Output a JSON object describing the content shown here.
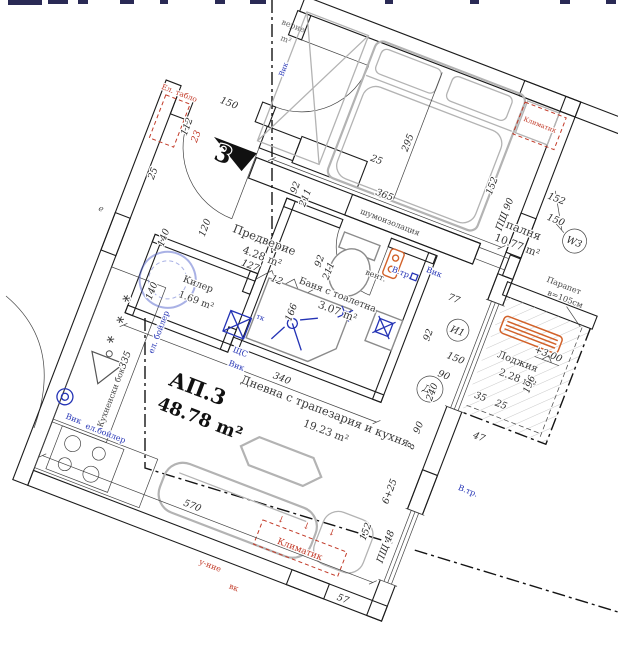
{
  "apartment": {
    "code": "АП.3",
    "area": "48.78 m²"
  },
  "rooms": {
    "bedroom": {
      "name": "Спалня",
      "area": "10.77 m²"
    },
    "hall": {
      "name": "Предверие",
      "area": "4.28 m²"
    },
    "storage": {
      "name": "Килер",
      "area": "1.69 m²"
    },
    "bathroom": {
      "name": "Баня с тоалетна",
      "area": "3.07 m²"
    },
    "living": {
      "name": "Дневна с трапезария и кухня",
      "area": "19.23 m²"
    },
    "loggia": {
      "name": "Лоджия",
      "area": "2.28 m²"
    }
  },
  "notes": {
    "kitchen": "Кухненски бокс",
    "noise": "шумоизолация",
    "parapet_l1": "Парапет",
    "parapet_l2": "в=105см",
    "level": "+3.00",
    "vent": "вент.",
    "letter_e": "е",
    "frag1": "верие",
    "frag2": "m²"
  },
  "red_notes": {
    "panel": "Ел. табло",
    "ac": "Климатик",
    "note_a": "у-ние",
    "note_b": "вк",
    "arrow": "↓"
  },
  "blue_notes": {
    "vik": "Вик",
    "boiler_v": "ел. бойлер",
    "boiler_h": "ел.бойлер",
    "vtr": "В.тр.",
    "shts": "ЩС",
    "tk": "тк"
  },
  "marks": {
    "w3": "W3",
    "w3_num1": "152",
    "w3_num2": "150",
    "d3": "Д3",
    "i1": "И1",
    "entrance_no": "3",
    "psht90": "ПЩ 90",
    "psht48": "ПЩ 48"
  },
  "dims": [
    "150",
    "25",
    "92",
    "211",
    "112",
    "23",
    "127",
    "12",
    "25",
    "140",
    "120",
    "140",
    "335",
    "365",
    "295",
    "152",
    "92",
    "211",
    "166",
    "340",
    "570",
    "77",
    "92",
    "150",
    "90",
    "196",
    "35",
    "25",
    "47",
    "240",
    "90",
    "8",
    "57",
    "6+25",
    "152"
  ],
  "colors": {
    "red": "#c23a28",
    "blue": "#2433b5",
    "orange": "#d2622a",
    "ink": "#1c1c1c"
  }
}
